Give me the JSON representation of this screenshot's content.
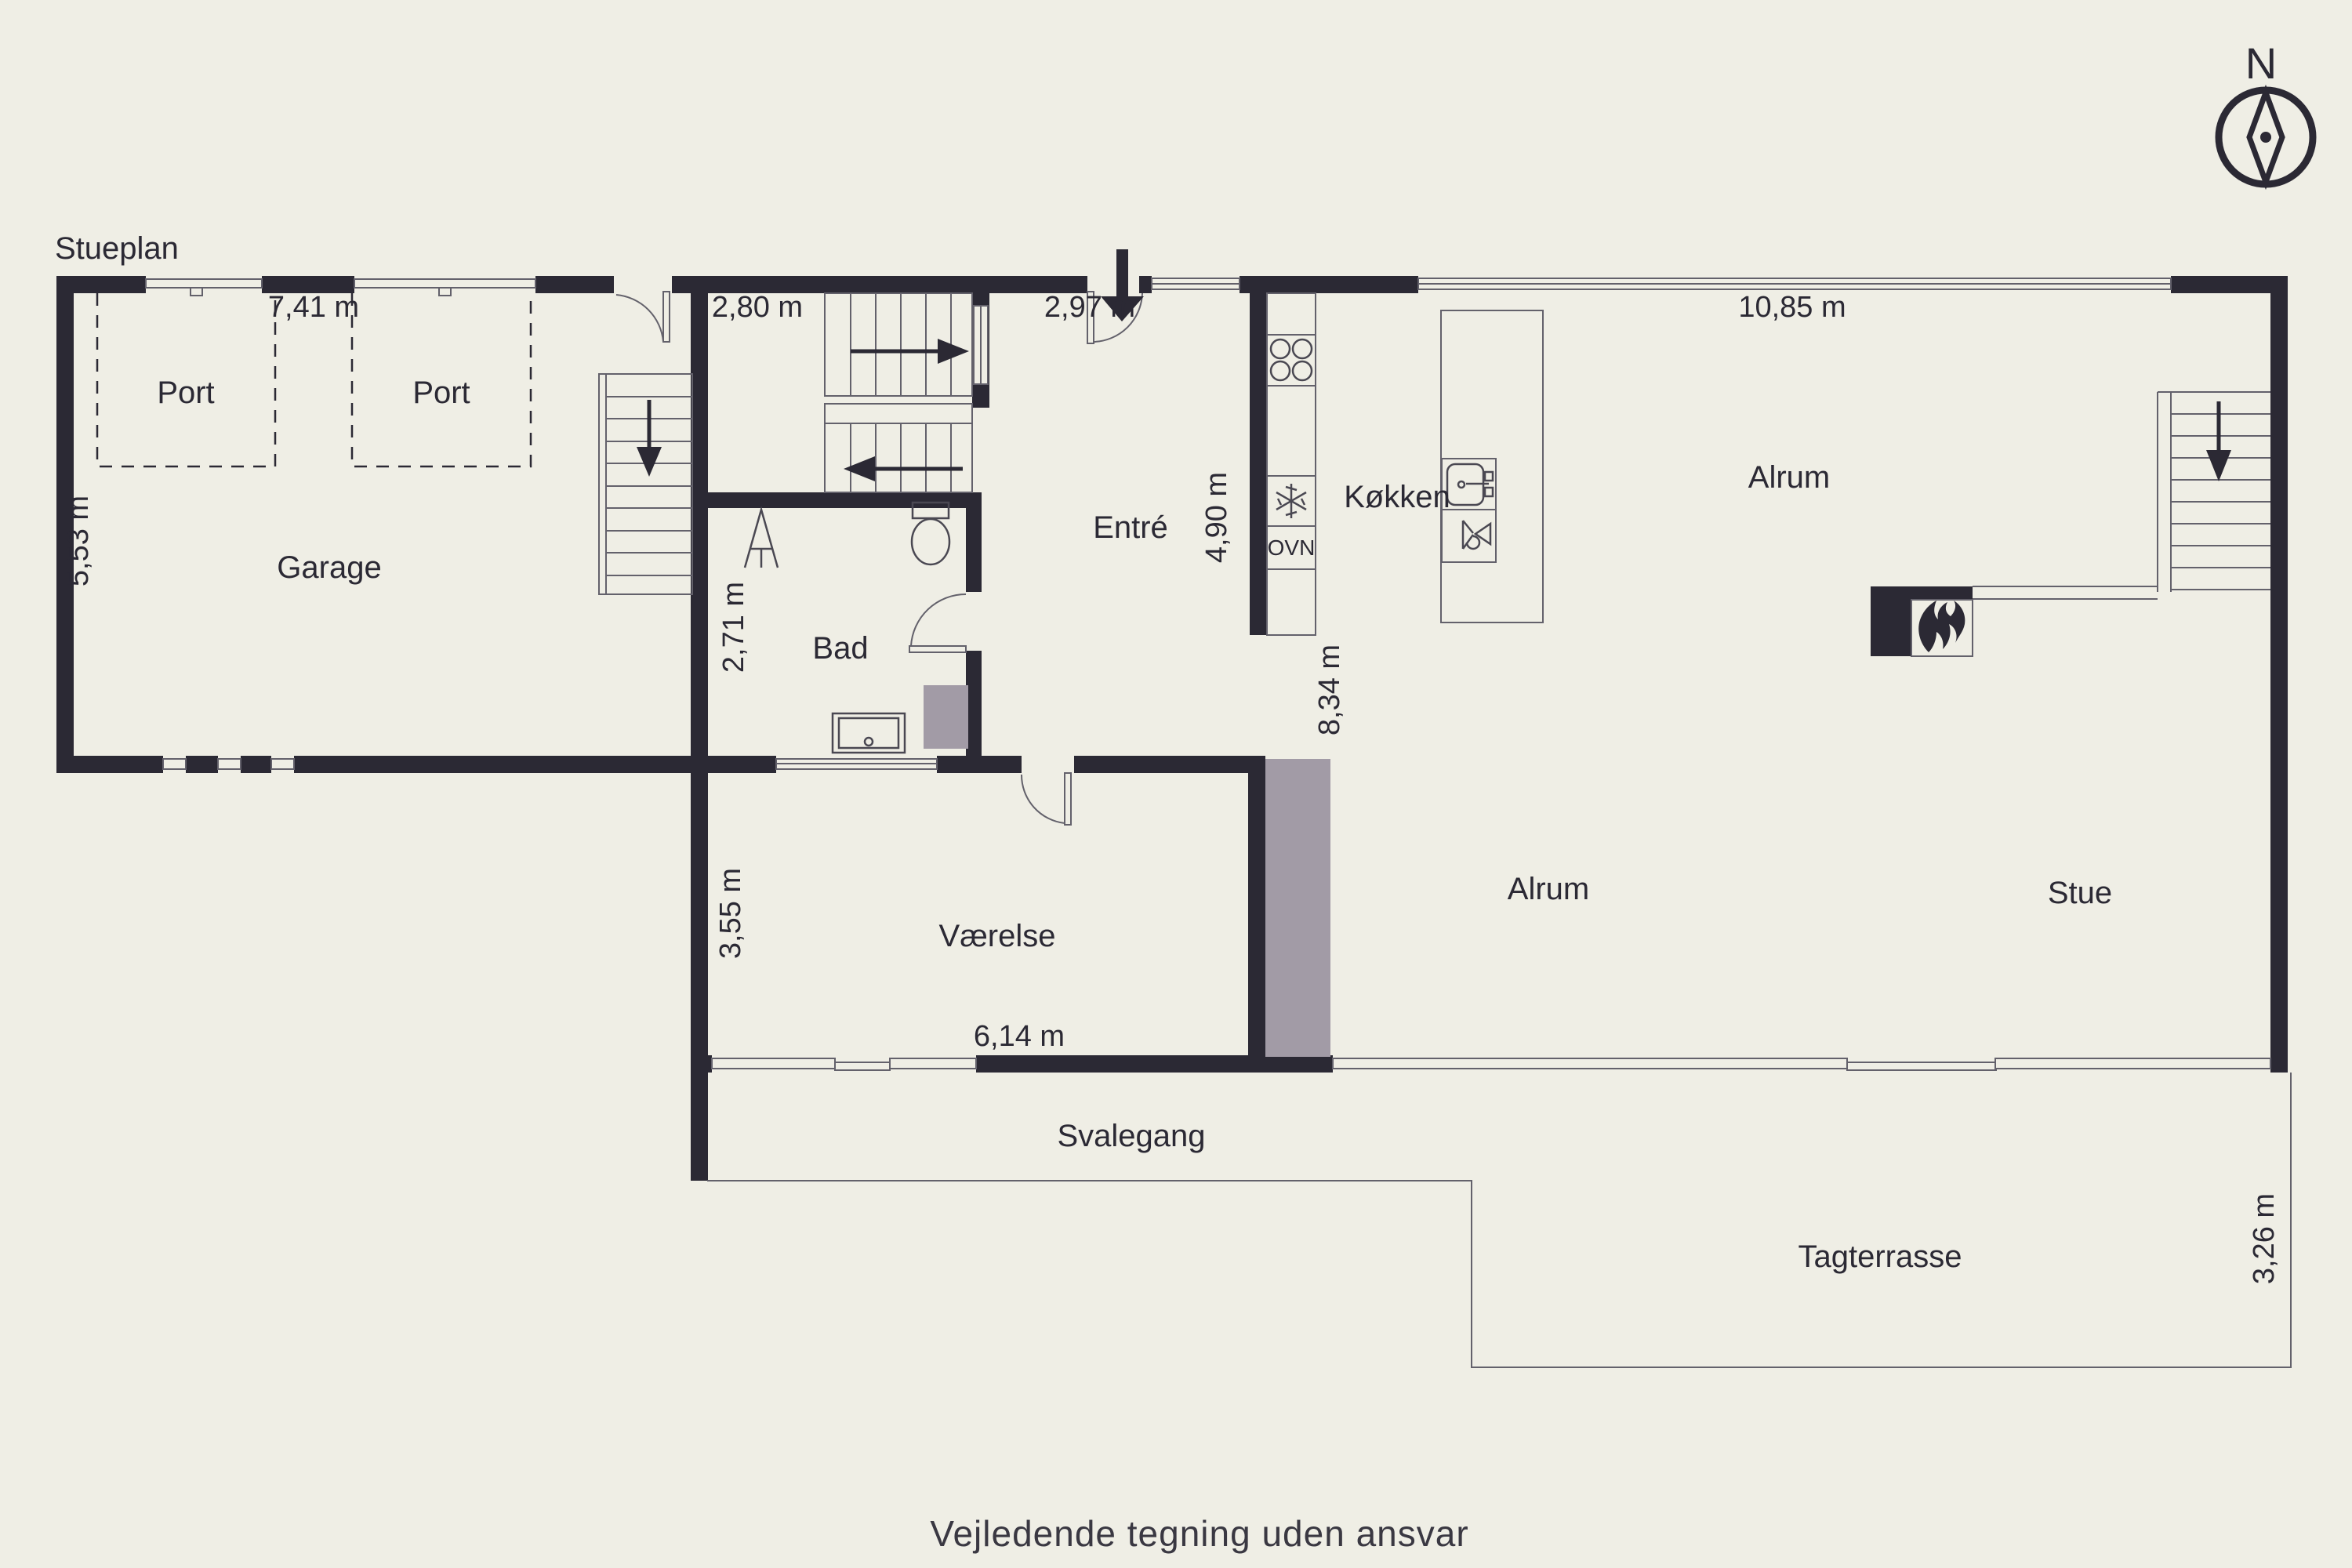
{
  "page": {
    "title": "Stueplan",
    "disclaimer": "Vejledende tegning uden ansvar"
  },
  "compass": {
    "north_label": "N"
  },
  "colors": {
    "background": "#efeee5",
    "wall": "#2b2934",
    "accent_gray": "#a29ba6",
    "thin_line": "#63616b",
    "text": "#2b2934"
  },
  "rooms": {
    "port1": {
      "label": "Port"
    },
    "port2": {
      "label": "Port"
    },
    "garage": {
      "label": "Garage"
    },
    "bad": {
      "label": "Bad"
    },
    "entre": {
      "label": "Entré"
    },
    "kokken": {
      "label": "Køkken"
    },
    "alrum_upper": {
      "label": "Alrum"
    },
    "alrum_lower": {
      "label": "Alrum"
    },
    "stue": {
      "label": "Stue"
    },
    "vaerelse": {
      "label": "Værelse"
    },
    "svalegang": {
      "label": "Svalegang"
    },
    "tagterrasse": {
      "label": "Tagterrasse"
    }
  },
  "appliances": {
    "oven_label": "OVN"
  },
  "dimensions": {
    "garage_width": "7,41 m",
    "garage_depth": "5,53 m",
    "hall_width": "2,80 m",
    "entre_width": "2,97 m",
    "alrum_width": "10,85 m",
    "kitchen_depth": "4,90 m",
    "bad_depth": "2,71 m",
    "alrum_depth": "8,34 m",
    "vaerelse_depth": "3,55 m",
    "vaerelse_width": "6,14 m",
    "terrace_depth": "3,26 m"
  }
}
